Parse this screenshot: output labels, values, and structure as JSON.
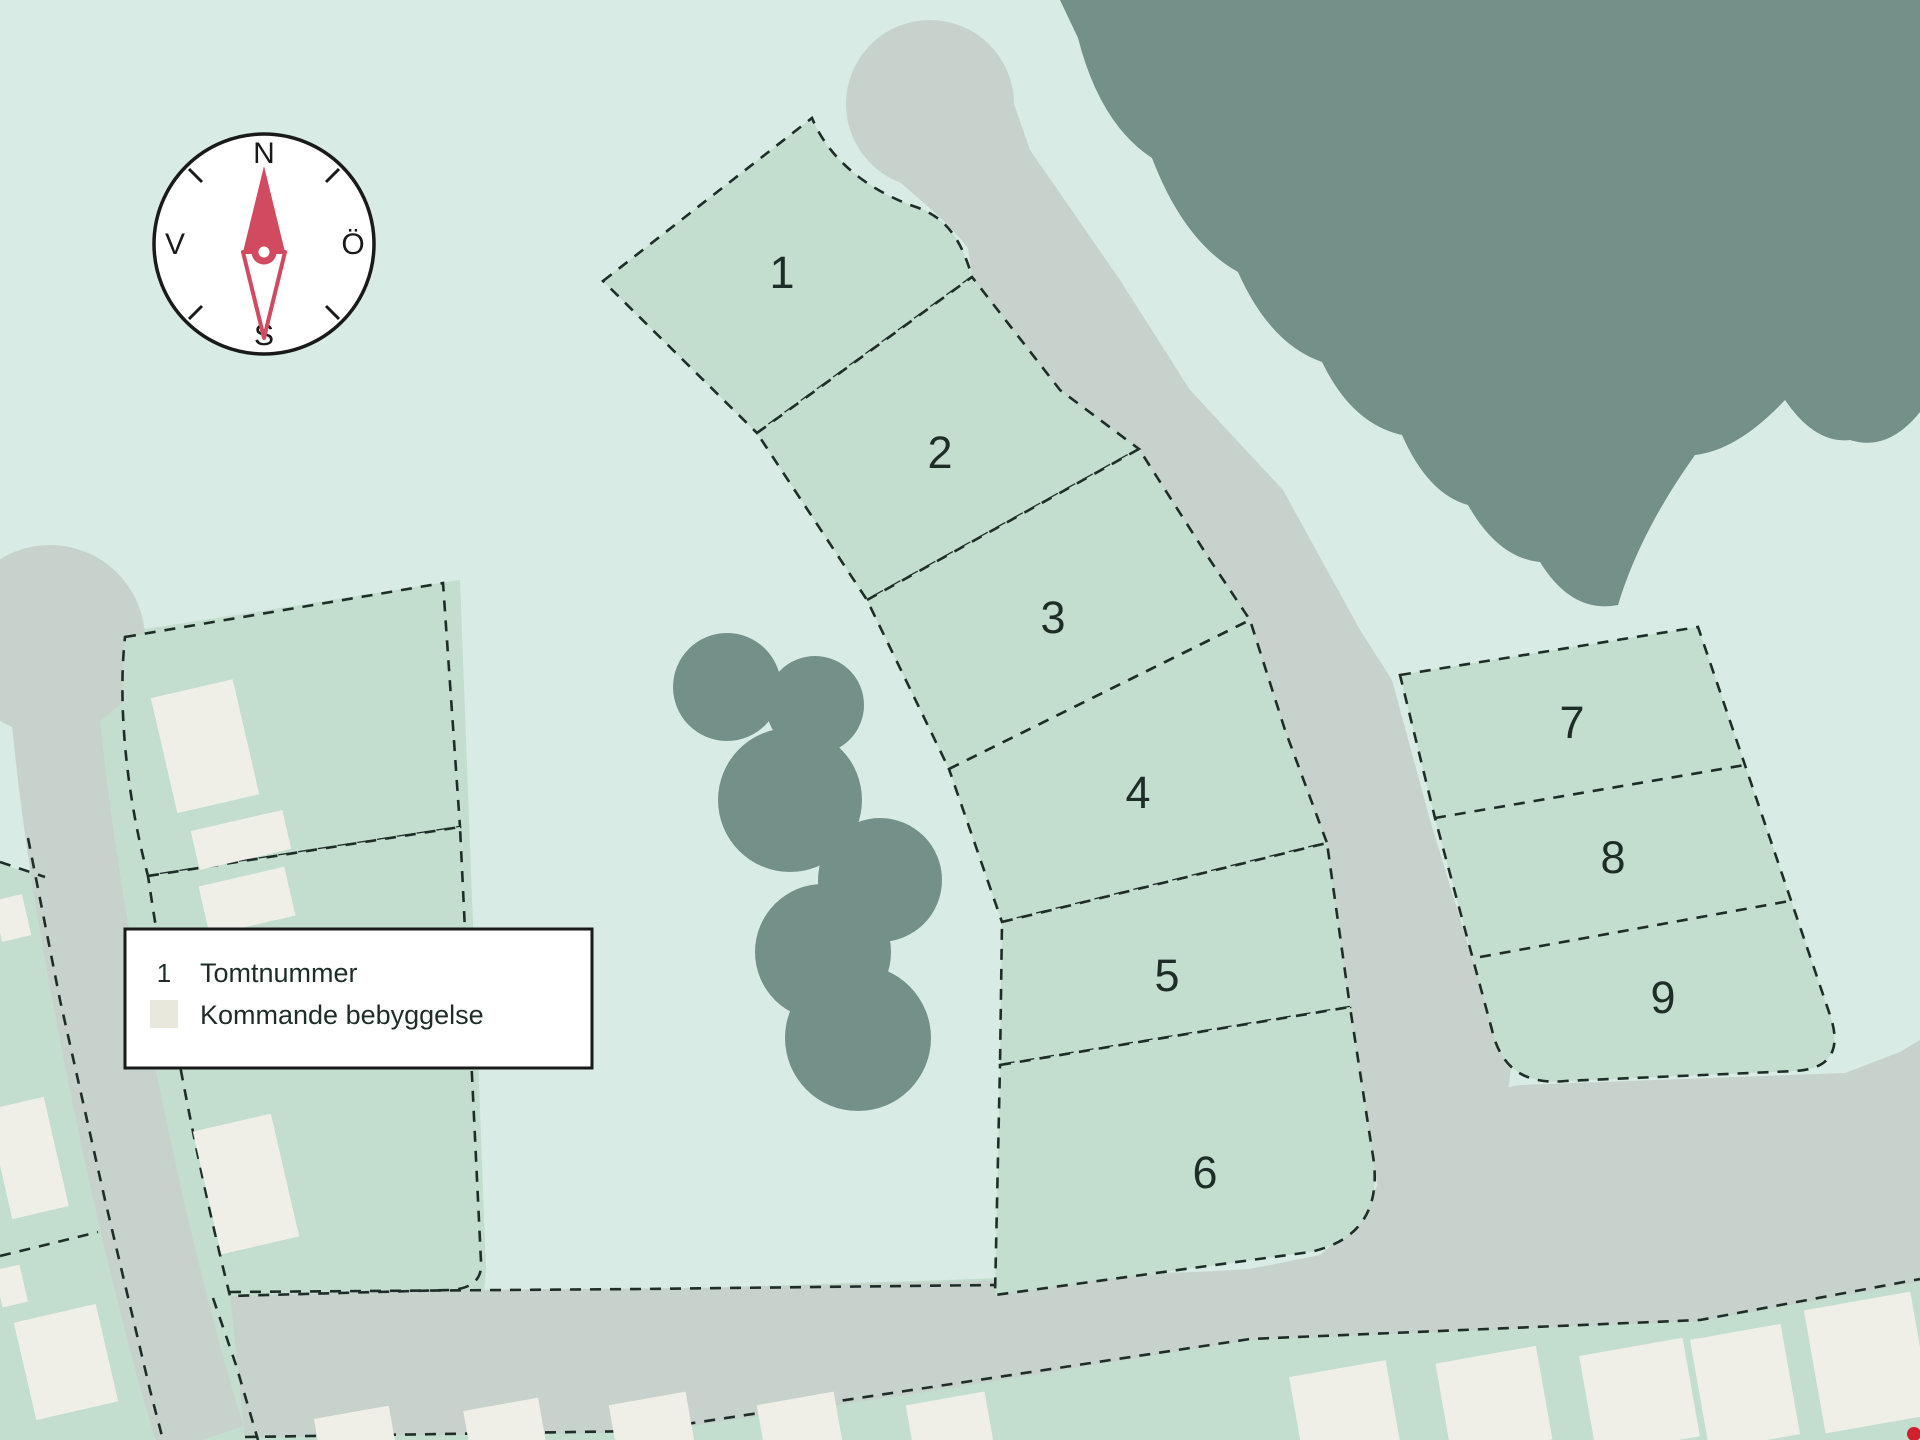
{
  "compass": {
    "north_label": "N",
    "east_label": "Ö",
    "south_label": "S",
    "west_label": "V"
  },
  "legend": {
    "items": [
      {
        "symbol": "1",
        "label": "Tomtnummer"
      },
      {
        "symbol": "",
        "label": "Kommande bebyggelse"
      }
    ]
  },
  "plots": [
    {
      "id": "plot-1",
      "label": "1"
    },
    {
      "id": "plot-2",
      "label": "2"
    },
    {
      "id": "plot-3",
      "label": "3"
    },
    {
      "id": "plot-4",
      "label": "4"
    },
    {
      "id": "plot-5",
      "label": "5"
    },
    {
      "id": "plot-6",
      "label": "6"
    },
    {
      "id": "plot-7",
      "label": "7"
    },
    {
      "id": "plot-8",
      "label": "8"
    },
    {
      "id": "plot-9",
      "label": "9"
    }
  ],
  "colors": {
    "background": "#d8ebe4",
    "plot_fill": "#c3ddcf",
    "road": "#c7d2cc",
    "tree": "#739089",
    "building": "#f0efe7",
    "legend_swatch": "#e9e8dc",
    "boundary_line": "#1f2d28",
    "compass_needle": "#d14a60",
    "marker_red": "#d0202e"
  }
}
